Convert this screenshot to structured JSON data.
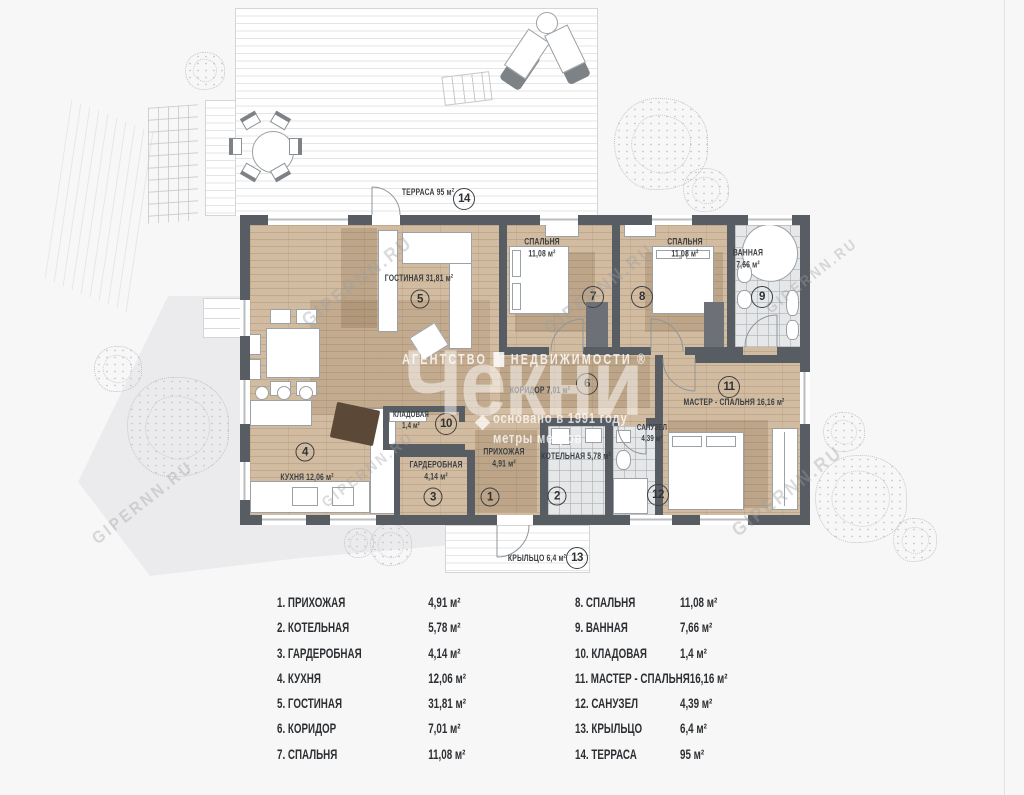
{
  "brand": {
    "agency_prefix": "АГЕНТСТВО",
    "agency_suffix": "НЕДВИЖИМОСТИ ®",
    "logo": "Чекни",
    "tagline": "основано в 1991 году\nметры метров",
    "diagonal_watermark": "GIPERNN.RU"
  },
  "plan": {
    "rooms": [
      {
        "id": "terrace",
        "num": "14",
        "label": "ТЕРРАСА 95 м²"
      },
      {
        "id": "living",
        "num": "5",
        "label": "ГОСТИНАЯ 31,81 м²"
      },
      {
        "id": "kitchen",
        "num": "4",
        "label": "КУХНЯ 12,06 м²"
      },
      {
        "id": "pantry",
        "num": "10",
        "label": "КЛАДОВАЯ\n1,4 м²"
      },
      {
        "id": "wardrobe",
        "num": "3",
        "label": "ГАРДЕРОБНАЯ\n4,14 м²"
      },
      {
        "id": "hallway",
        "num": "1",
        "label": "ПРИХОЖАЯ\n4,91 м²"
      },
      {
        "id": "boiler",
        "num": "2",
        "label": "КОТЕЛЬНАЯ 5,78 м²"
      },
      {
        "id": "corridor",
        "num": "6",
        "label": "КОРИДОР 7,01 м²"
      },
      {
        "id": "bedroom-1",
        "num": "7",
        "label": "СПАЛЬНЯ\n11,08 м²"
      },
      {
        "id": "bedroom-2",
        "num": "8",
        "label": "СПАЛЬНЯ\n11,08 м²"
      },
      {
        "id": "bathroom",
        "num": "9",
        "label": "ВАННАЯ\n7,66 м²"
      },
      {
        "id": "master",
        "num": "11",
        "label": "МАСТЕР - СПАЛЬНЯ 16,16 м²"
      },
      {
        "id": "wc",
        "num": "12",
        "label": "САНУЗЕЛ\n4,39 м²"
      },
      {
        "id": "porch",
        "num": "13",
        "label": "КРЫЛЬЦО 6,4 м²"
      }
    ]
  },
  "legend": {
    "left": [
      {
        "name": "1. ПРИХОЖАЯ",
        "area": "4,91 м²"
      },
      {
        "name": "2. КОТЕЛЬНАЯ",
        "area": "5,78 м²"
      },
      {
        "name": "3. ГАРДЕРОБНАЯ",
        "area": "4,14 м²"
      },
      {
        "name": "4. КУХНЯ",
        "area": "12,06 м²"
      },
      {
        "name": "5. ГОСТИНАЯ",
        "area": "31,81 м²"
      },
      {
        "name": "6. КОРИДОР",
        "area": "7,01 м²"
      },
      {
        "name": "7. СПАЛЬНЯ",
        "area": "11,08 м²"
      }
    ],
    "right": [
      {
        "name": "8. СПАЛЬНЯ",
        "area": "11,08 м²"
      },
      {
        "name": "9. ВАННАЯ",
        "area": "7,66 м²"
      },
      {
        "name": "10. КЛАДОВАЯ",
        "area": "1,4 м²"
      },
      {
        "name": "11. МАСТЕР - СПАЛЬНЯ",
        "area": "16,16 м²"
      },
      {
        "name": "12. САНУЗЕЛ",
        "area": "4,39 м²"
      },
      {
        "name": "13. КРЫЛЬЦО",
        "area": "6,4 м²"
      },
      {
        "name": "14. ТЕРРАСА",
        "area": "95 м²"
      }
    ]
  },
  "colors": {
    "wall": "#585d64",
    "wood": "#d2bca1",
    "tile": "#e5e7e9",
    "deck_line": "#e4e5e6"
  }
}
